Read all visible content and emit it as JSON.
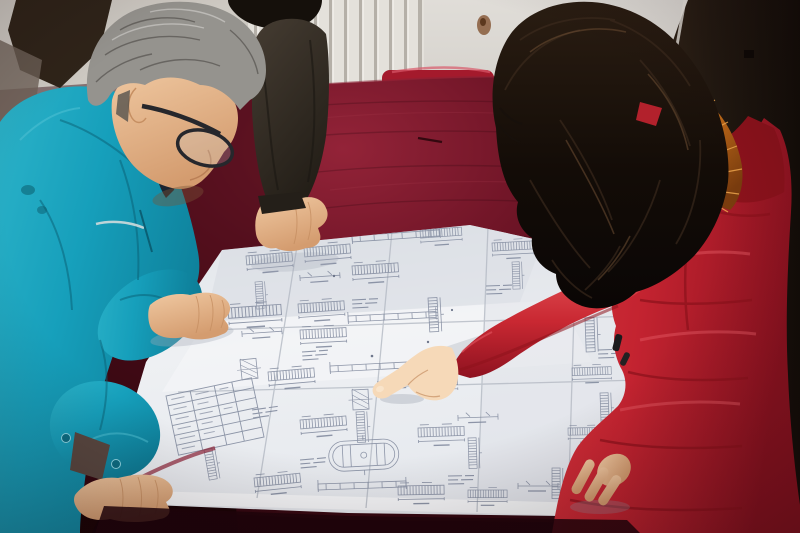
{
  "scene": {
    "description": "Photograph: two people lean over a large folded white engineering blueprint spread on a table draped in crimson velvet. A gray-haired man in a teal work jacket and dark-rimmed glasses studies the drawing from the left with both hands on it; a woman in a red padded winter coat with an orange fur-trimmed hood points at a detail with her right index finger. A third person in a dark jacket rests one hand on the top edge of the sheet. Behind them are a white finned radiator, a light wall, a red chrome-framed chair and a dark door.",
    "people": [
      {
        "id": "man-left",
        "description": "Middle-aged man, gray hair, dark-rimmed glasses, teal work jacket, leaning over the drawing with both hands on it"
      },
      {
        "id": "woman-right",
        "description": "Woman with long dark wavy hair, red padded coat with orange fur-trimmed hood, pointing at the drawing with her right index finger, left hand resting on the sheet"
      },
      {
        "id": "person-background",
        "description": "Third person in a dark olive jacket, mostly out of frame, one hand resting on the top edge of the drawing"
      }
    ],
    "objects": [
      {
        "id": "blueprint-sheet",
        "description": "Large folded white construction drawing covered with small beam schedules, rebar ladder details, dimension lines, a parts table and an oval section detail"
      },
      {
        "id": "table",
        "description": "Table covered with a dark crimson velvet cloth"
      },
      {
        "id": "radiator",
        "description": "White wall radiator with vertical fins"
      },
      {
        "id": "chair",
        "description": "Red chair with a chrome tube frame behind the table"
      },
      {
        "id": "door",
        "description": "Dark brown door panel on the right"
      }
    ]
  },
  "palette": {
    "wall": "#d9d6d0",
    "wallDim": "#cbc7c0",
    "radiatorLight": "#e4e1db",
    "radiatorDark": "#b5b0a8",
    "stain": "#7c4a26",
    "door": "#261c14",
    "doorDark": "#140e09",
    "doorEdge": "#e8e5de",
    "chrome": "#c7c9ca",
    "chairRed": "#a41a2c",
    "velvet": "#6d1425",
    "velvetBright": "#932338",
    "velvetDark": "#2e0710",
    "velvetEdge": "#8c2236",
    "paper": "#eaedf0",
    "paperShade": "#d7dbe1",
    "paperBright": "#f7f8fa",
    "crease": "#b4bac4",
    "ink": "#7d869b",
    "inkDark": "#59627a",
    "teal": "#169fbb",
    "tealDark": "#0d7c96",
    "tealDeep": "#0a5f74",
    "collar": "#1c2430",
    "skin": "#eec29c",
    "skinShadow": "#c68f62",
    "skinBright": "#f6d9b8",
    "hairGray": "#95938e",
    "hairGrayDark": "#55524e",
    "hairDark": "#15100b",
    "hairBrown": "#3f2d1f",
    "coat": "#c32330",
    "coatDark": "#8e121c",
    "coatBright": "#e25560",
    "fur": "#c06a18",
    "furDark": "#7c3d0e",
    "furBright": "#f2a94f",
    "olive": "#3a322a",
    "oliveDark": "#241f19"
  }
}
